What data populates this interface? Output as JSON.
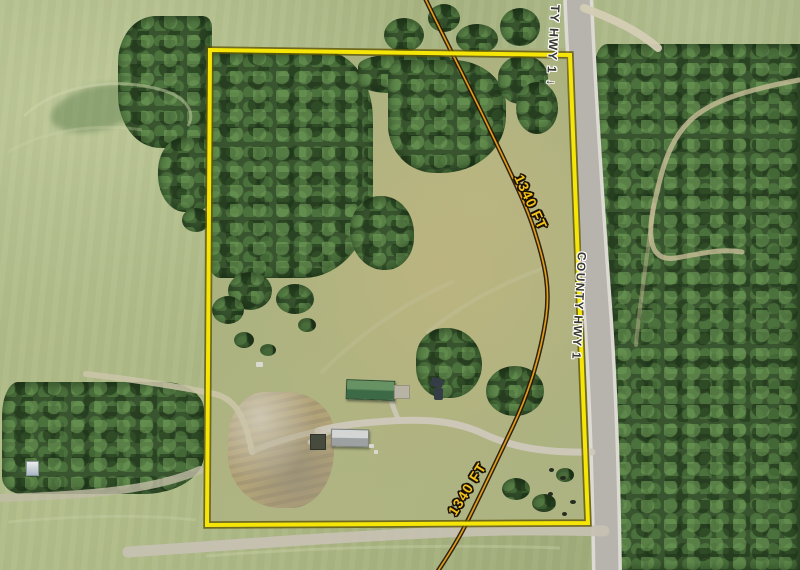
{
  "map": {
    "kind": "aerial-parcel-map",
    "labels": {
      "highway_top_partial": "TY HWY 1",
      "highway_top_arrow": "↓",
      "highway_middle": "COUNTY HWY 1",
      "dimension_upper": "1340 FT",
      "dimension_lower": "1340 FT"
    },
    "colors": {
      "parcel_boundary": "#f5e608",
      "boundary_casing": "#605808",
      "dimension_line": "#df9c1b",
      "dimension_line_casing": "#241604",
      "dimension_text": "#f3c11c",
      "road_label_text": "#3a392f",
      "road_label_halo": "#ffffff",
      "road_surface": "#b6b4ad",
      "field_green": "#a6b27f",
      "forest_green": "#39552f"
    }
  }
}
